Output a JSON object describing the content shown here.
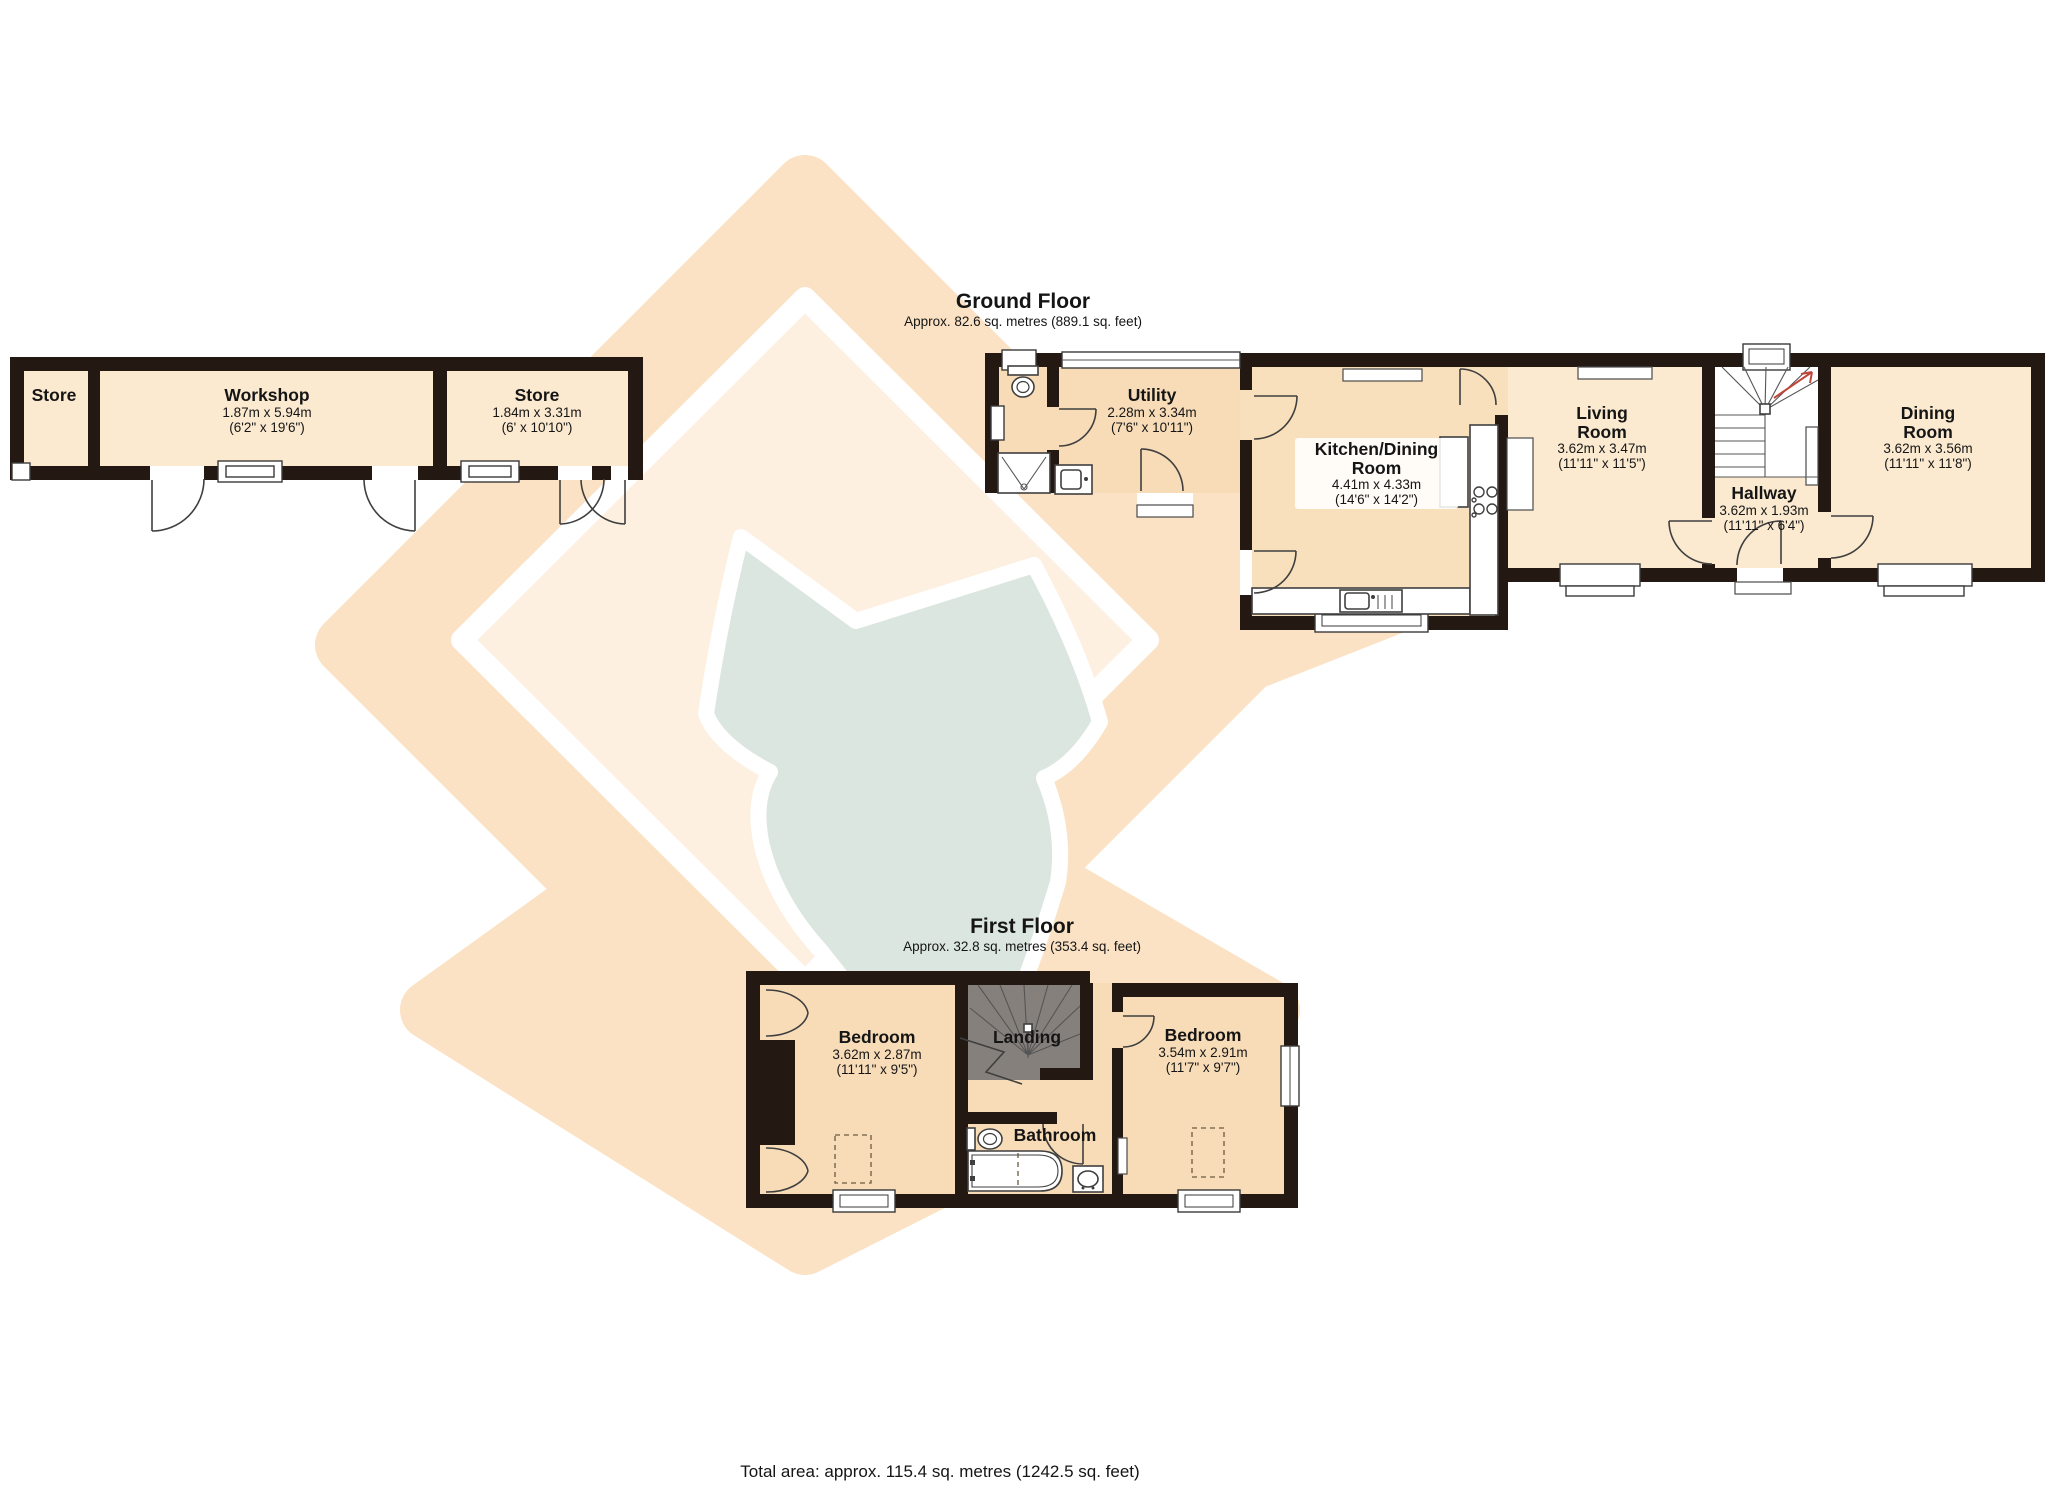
{
  "document_type": "floorplan",
  "footer": {
    "total_area": "Total area: approx. 115.4 sq. metres (1242.5 sq. feet)"
  },
  "floors": {
    "outbuilding": {
      "rooms": {
        "store_left": {
          "name": "Store"
        },
        "workshop": {
          "name": "Workshop",
          "dims_metric": "1.87m x 5.94m",
          "dims_imperial": "(6'2\" x 19'6\")"
        },
        "store_right": {
          "name": "Store",
          "dims_metric": "1.84m x 3.31m",
          "dims_imperial": "(6' x 10'10\")"
        }
      }
    },
    "ground": {
      "title": "Ground Floor",
      "subtitle": "Approx. 82.6 sq. metres (889.1 sq. feet)",
      "rooms": {
        "utility": {
          "name": "Utility",
          "dims_metric": "2.28m x 3.34m",
          "dims_imperial": "(7'6\" x 10'11\")"
        },
        "kitchen_dining": {
          "name": "Kitchen/Dining Room",
          "dims_metric": "4.41m x 4.33m",
          "dims_imperial": "(14'6\" x 14'2\")"
        },
        "living": {
          "name": "Living Room",
          "dims_metric": "3.62m x 3.47m",
          "dims_imperial": "(11'11\" x 11'5\")"
        },
        "hallway": {
          "name": "Hallway",
          "dims_metric": "3.62m x 1.93m",
          "dims_imperial": "(11'11\" x 6'4\")"
        },
        "dining": {
          "name": "Dining Room",
          "dims_metric": "3.62m x 3.56m",
          "dims_imperial": "(11'11\" x 11'8\")"
        }
      }
    },
    "first": {
      "title": "First Floor",
      "subtitle": "Approx. 32.8 sq. metres (353.4 sq. feet)",
      "rooms": {
        "bedroom_left": {
          "name": "Bedroom",
          "dims_metric": "3.62m x 2.87m",
          "dims_imperial": "(11'11\" x 9'5\")"
        },
        "landing": {
          "name": "Landing"
        },
        "bathroom": {
          "name": "Bathroom"
        },
        "bedroom_right": {
          "name": "Bedroom",
          "dims_metric": "3.54m x 2.91m",
          "dims_imperial": "(11'7\" x 9'7\")"
        }
      }
    }
  },
  "colors": {
    "wall": "#241912",
    "room_cream": "#fbead0",
    "room_tint": "#f8dcb8",
    "room_kitchen": "#f9e0bd",
    "watermark_peach": "#fbe2c4",
    "watermark_peach_inner": "#fdf0e1",
    "watermark_fox": "#dce6e0",
    "stair_arrow": "#c0463a"
  }
}
